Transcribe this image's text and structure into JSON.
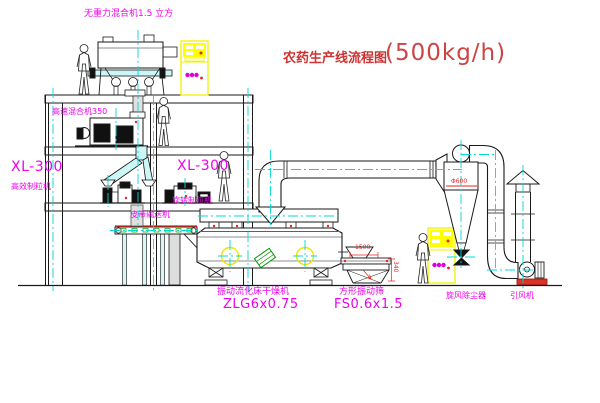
{
  "title": {
    "name": "农药生产线流程图",
    "capacity": "(500kg/h)"
  },
  "equipment_labels": {
    "gravity_mixer": "无重力混合机1.5 立方",
    "high_speed_mixer": "高速混合机350",
    "left_granulator_model": "XL-300",
    "left_granulator_name": "高效制粒机",
    "mid_granulator_model": "XL-300",
    "mid_granulator_name": "旋转制粒机",
    "belt_conveyor": "皮带输送机",
    "dryer_name": "振动流化床干燥机",
    "dryer_model": "ZLG6x0.75",
    "sieve_name": "方形振动筛",
    "sieve_model": "FS0.6x1.5",
    "cyclone_name": "旋风除尘器",
    "fan_name": "引风机"
  },
  "dimension_labels": {
    "sieve_length": "1500",
    "sieve_height": "340",
    "cyclone_diameter": "Φ600"
  },
  "colors": {
    "label_magenta": "#ee00ee",
    "title_red": "#cc3333",
    "centerline_cyan": "#00d8d8",
    "cabinet_yellow": "#f0f000",
    "accent_red": "#ee2222",
    "accent_green": "#009900",
    "line_black": "#1a1a1a"
  }
}
